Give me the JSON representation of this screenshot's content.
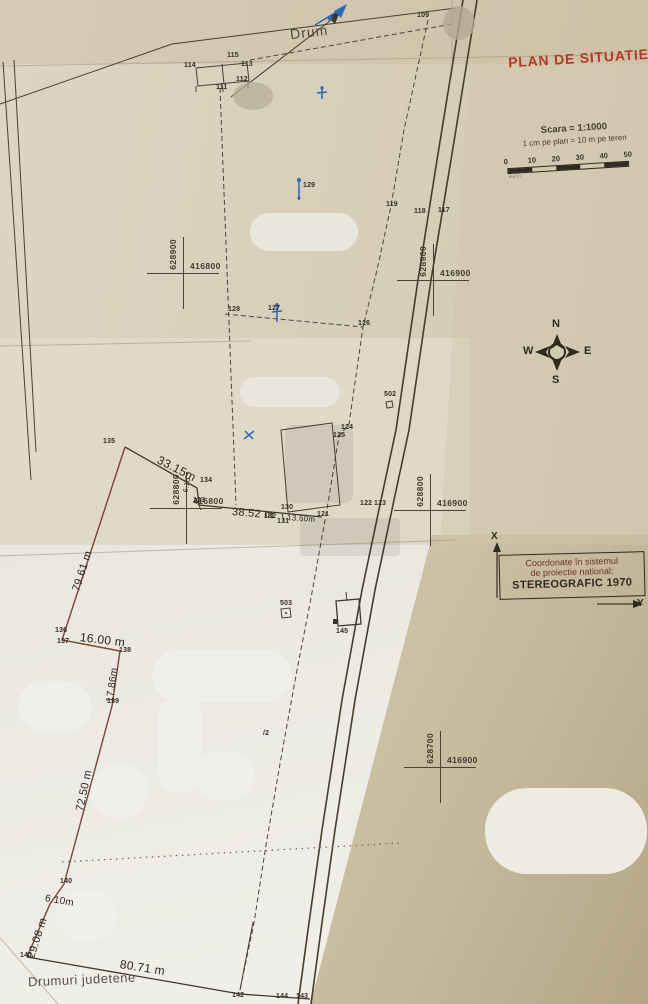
{
  "title": "PLAN DE SITUATIE",
  "scale": {
    "line1": "Scara = 1:1000",
    "line2": "1 cm pe plan = 10 m pe teren",
    "ticks": [
      "0",
      "10",
      "20",
      "30",
      "40",
      "50"
    ],
    "unit_label": "metri"
  },
  "compass": {
    "n": "N",
    "e": "E",
    "s": "S",
    "w": "W"
  },
  "coord_box": {
    "line1": "Coordonate în sistemul",
    "line2": "de proiectie national:",
    "line3": "STEREOGRAFIC 1970",
    "x_label": "X",
    "y_label": "Y"
  },
  "road_labels": {
    "top": "Drum",
    "bottom": "Drumuri judetene"
  },
  "grid_crosses": [
    {
      "x": 183,
      "y": 273,
      "northing": "628900",
      "easting": "416800"
    },
    {
      "x": 433,
      "y": 280,
      "northing": "628900",
      "easting": "416900"
    },
    {
      "x": 186,
      "y": 508,
      "northing": "628800",
      "easting": "416800"
    },
    {
      "x": 430,
      "y": 510,
      "northing": "628800",
      "easting": "416900"
    },
    {
      "x": 440,
      "y": 767,
      "northing": "628700",
      "easting": "416900"
    }
  ],
  "points": [
    {
      "id": "109",
      "x": 417,
      "y": 12
    },
    {
      "id": "115",
      "x": 227,
      "y": 52
    },
    {
      "id": "113",
      "x": 241,
      "y": 61
    },
    {
      "id": "114",
      "x": 184,
      "y": 62
    },
    {
      "id": "112",
      "x": 236,
      "y": 76
    },
    {
      "id": "111",
      "x": 216,
      "y": 84
    },
    {
      "id": "129",
      "x": 303,
      "y": 182
    },
    {
      "id": "119",
      "x": 386,
      "y": 201
    },
    {
      "id": "118",
      "x": 414,
      "y": 208
    },
    {
      "id": "117",
      "x": 438,
      "y": 207
    },
    {
      "id": "128",
      "x": 228,
      "y": 306
    },
    {
      "id": "127",
      "x": 268,
      "y": 305
    },
    {
      "id": "126",
      "x": 358,
      "y": 320
    },
    {
      "id": "502",
      "x": 384,
      "y": 391
    },
    {
      "id": "124",
      "x": 341,
      "y": 424
    },
    {
      "id": "125",
      "x": 333,
      "y": 432
    },
    {
      "id": "135",
      "x": 103,
      "y": 438
    },
    {
      "id": "134",
      "x": 200,
      "y": 477
    },
    {
      "id": "133",
      "x": 193,
      "y": 497
    },
    {
      "id": "130",
      "x": 281,
      "y": 504
    },
    {
      "id": "132",
      "x": 264,
      "y": 513
    },
    {
      "id": "131",
      "x": 277,
      "y": 518
    },
    {
      "id": "121",
      "x": 317,
      "y": 511
    },
    {
      "id": "122",
      "x": 360,
      "y": 500
    },
    {
      "id": "123",
      "x": 374,
      "y": 500
    },
    {
      "id": "503",
      "x": 280,
      "y": 600
    },
    {
      "id": "145",
      "x": 336,
      "y": 628
    },
    {
      "id": "136",
      "x": 55,
      "y": 627
    },
    {
      "id": "137",
      "x": 57,
      "y": 638
    },
    {
      "id": "138",
      "x": 119,
      "y": 647
    },
    {
      "id": "139",
      "x": 107,
      "y": 698
    },
    {
      "id": "/2",
      "x": 263,
      "y": 730
    },
    {
      "id": "140",
      "x": 60,
      "y": 878
    },
    {
      "id": "141",
      "x": 20,
      "y": 952
    },
    {
      "id": "142",
      "x": 232,
      "y": 992
    },
    {
      "id": "144",
      "x": 276,
      "y": 993
    },
    {
      "id": "143",
      "x": 296,
      "y": 993
    }
  ],
  "measurements": [
    {
      "text": "33.15m",
      "x": 158,
      "y": 452,
      "rot": 27,
      "size": 12
    },
    {
      "text": "6.10",
      "x": 186,
      "y": 489,
      "rot": -80,
      "size": 7
    },
    {
      "text": "38.52 m",
      "x": 232,
      "y": 506,
      "rot": 5,
      "size": 11
    },
    {
      "text": "13.60m",
      "x": 287,
      "y": 513,
      "rot": 4,
      "size": 8
    },
    {
      "text": "79.61 m",
      "x": 76,
      "y": 585,
      "rot": -72,
      "size": 11
    },
    {
      "text": "16.00 m",
      "x": 80,
      "y": 630,
      "rot": 7,
      "size": 12
    },
    {
      "text": "17.86m",
      "x": 110,
      "y": 697,
      "rot": -82,
      "size": 10
    },
    {
      "text": "72.50 m",
      "x": 80,
      "y": 805,
      "rot": -78,
      "size": 11
    },
    {
      "text": "6.10m",
      "x": 45,
      "y": 893,
      "rot": 10,
      "size": 10
    },
    {
      "text": "29.08 m",
      "x": 31,
      "y": 952,
      "rot": -72,
      "size": 11
    },
    {
      "text": "80.71 m",
      "x": 120,
      "y": 957,
      "rot": 9,
      "size": 12
    }
  ],
  "colors": {
    "paper": "#d8cfba",
    "title_red": "#b23a26",
    "ink": "#3a362c",
    "boundary_red": "#7c4434",
    "pen_blue": "#2f66b5"
  }
}
